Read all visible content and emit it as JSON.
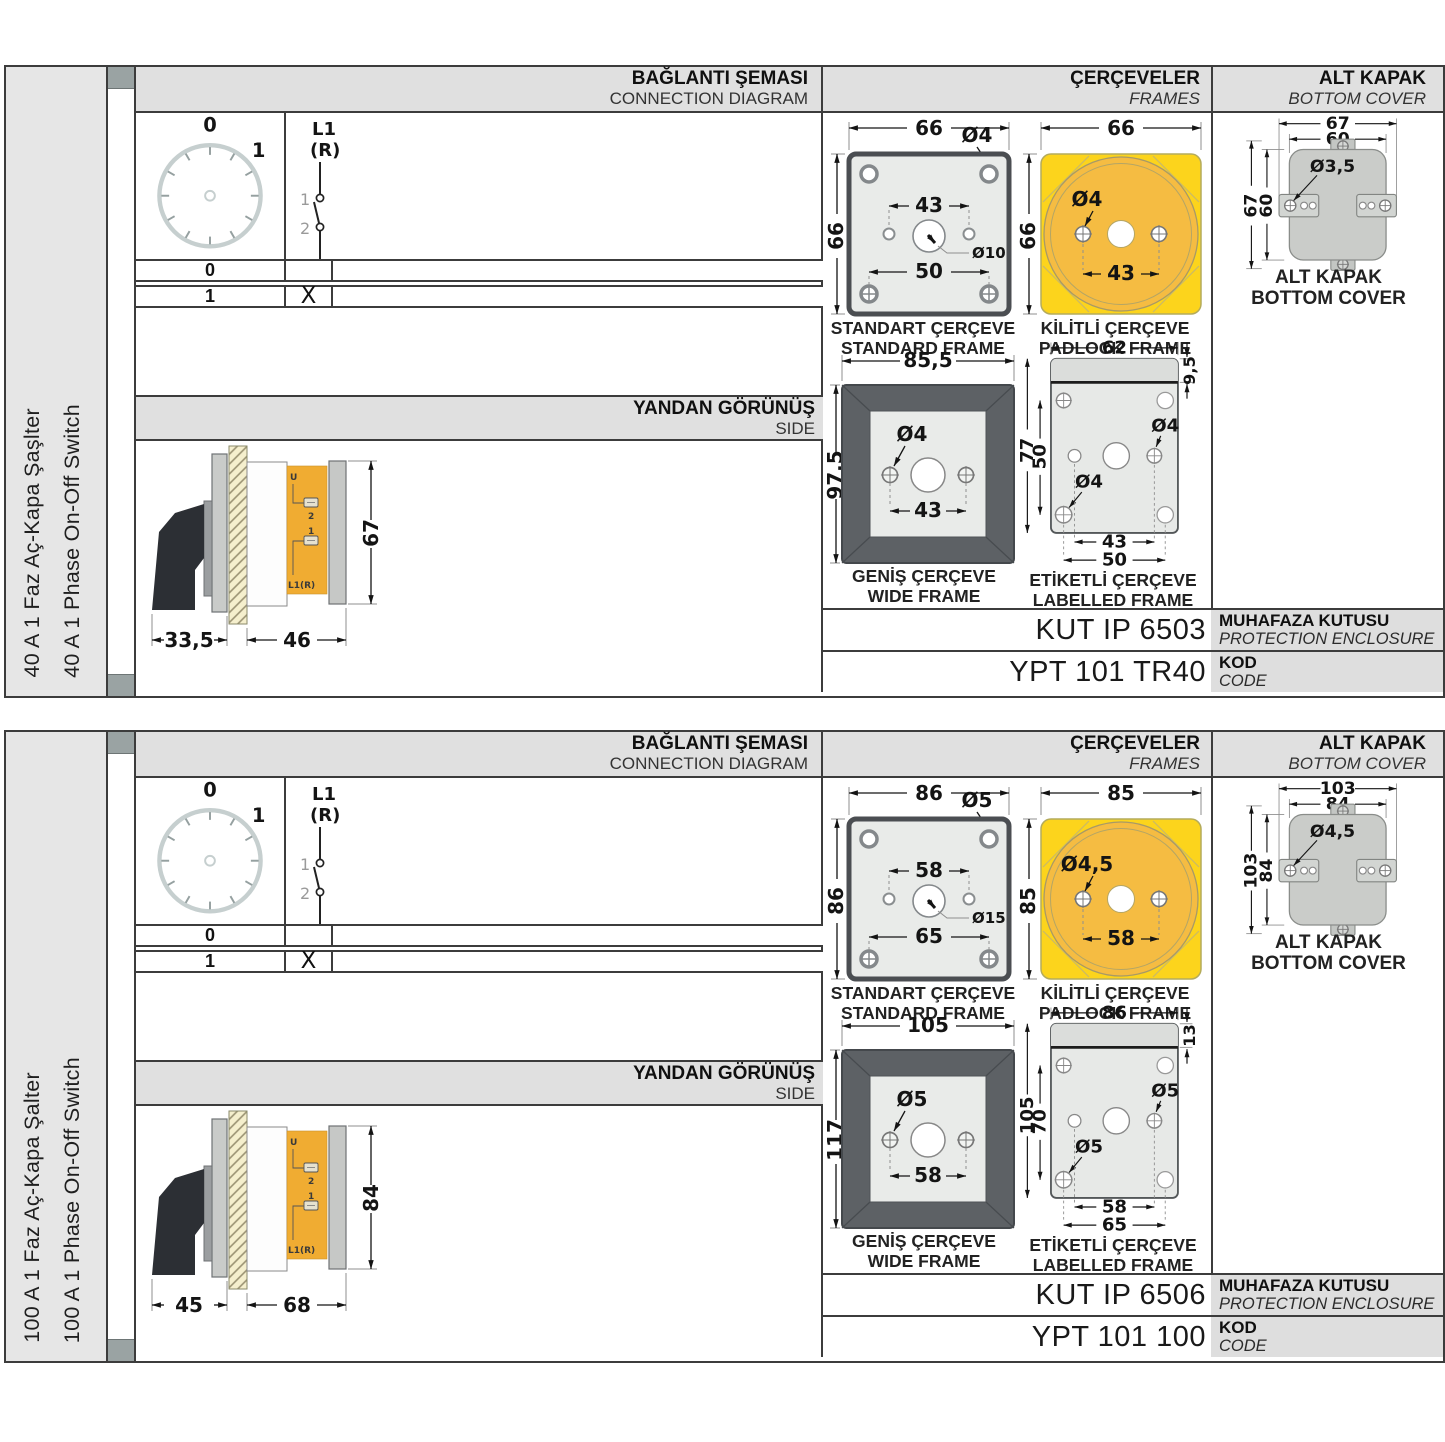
{
  "colors": {
    "padlock_yellow": "#fcd41c",
    "padlock_circle": "#f5bc42",
    "label_orange": "#f0ac32",
    "handle_dark": "#2c2f34",
    "header_gray": "#e0e0e0"
  },
  "panels": [
    {
      "product_tr": "40 A 1 Faz Aç-Kapa Şaşlter",
      "product_en": "40 A 1 Phase On-Off Switch",
      "headers": {
        "diagram_tr": "BAĞLANTI ŞEMASI",
        "diagram_en": "CONNECTION DIAGRAM",
        "frames_tr": "ÇERÇEVELER",
        "frames_en": "FRAMES",
        "cover_tr": "ALT KAPAK",
        "cover_en": "BOTTOM COVER"
      },
      "diagram": {
        "pos0": "0",
        "pos1": "1",
        "t_top1": "L1",
        "t_top2": "(R)",
        "c1": "1",
        "c2": "2",
        "t_bot": "U",
        "rows": [
          {
            "pos": "0",
            "state": ""
          },
          {
            "pos": "1",
            "state": "X"
          }
        ]
      },
      "side_view": {
        "title_tr": "YANDAN GÖRÜNÜŞ",
        "title_en": "SIDE",
        "dim_a": "33,5",
        "dim_b": "46",
        "dim_h": "67",
        "lbl_u": "U",
        "lbl_1": "1",
        "lbl_2": "2",
        "lbl_l1r": "L1(R)"
      },
      "frames": {
        "standard": {
          "cap_tr": "STANDART ÇERÇEVE",
          "cap_en": "STANDARD FRAME",
          "w": "66",
          "h": "66",
          "hole": "Ø4",
          "pitch": "43",
          "center_hole": "Ø10",
          "pitch_outer": "50"
        },
        "padlock": {
          "cap_tr": "KİLİTLİ ÇERÇEVE",
          "cap_en": "PADLOCK FRAME",
          "w": "66",
          "h": "66",
          "hole": "Ø4",
          "pitch": "43"
        },
        "wide": {
          "cap_tr": "GENİŞ ÇERÇEVE",
          "cap_en": "WIDE FRAME",
          "w": "85,5",
          "h": "97,5",
          "hole": "Ø4",
          "pitch": "43"
        },
        "labelled": {
          "cap_tr": "ETİKETLİ ÇERÇEVE",
          "cap_en": "LABELLED FRAME",
          "w": "62",
          "strip_h": "9,5",
          "h": "77",
          "inner_h": "50",
          "hole1": "Ø4",
          "hole2": "Ø4",
          "pitch": "43",
          "pitch_outer": "50"
        }
      },
      "cover": {
        "cap_tr": "ALT KAPAK",
        "cap_en": "BOTTOM COVER",
        "w1": "67",
        "w2": "60",
        "hole": "Ø3,5",
        "h1": "67",
        "h2": "60"
      },
      "enclosure": {
        "value": "KUT IP 6503",
        "label_tr": "MUHAFAZA KUTUSU",
        "label_en": "PROTECTION ENCLOSURE"
      },
      "code": {
        "value": "YPT 101 TR40",
        "label_tr": "KOD",
        "label_en": "CODE"
      }
    },
    {
      "product_tr": "100 A 1 Faz Aç-Kapa Şalter",
      "product_en": "100 A 1 Phase On-Off Switch",
      "headers": {
        "diagram_tr": "BAĞLANTI ŞEMASI",
        "diagram_en": "CONNECTION DIAGRAM",
        "frames_tr": "ÇERÇEVELER",
        "frames_en": "FRAMES",
        "cover_tr": "ALT KAPAK",
        "cover_en": "BOTTOM COVER"
      },
      "diagram": {
        "pos0": "0",
        "pos1": "1",
        "t_top1": "L1",
        "t_top2": "(R)",
        "c1": "1",
        "c2": "2",
        "t_bot": "U",
        "rows": [
          {
            "pos": "0",
            "state": ""
          },
          {
            "pos": "1",
            "state": "X"
          }
        ]
      },
      "side_view": {
        "title_tr": "YANDAN GÖRÜNÜŞ",
        "title_en": "SIDE",
        "dim_a": "45",
        "dim_b": "68",
        "dim_h": "84",
        "lbl_u": "U",
        "lbl_1": "1",
        "lbl_2": "2",
        "lbl_l1r": "L1(R)"
      },
      "frames": {
        "standard": {
          "cap_tr": "STANDART ÇERÇEVE",
          "cap_en": "STANDARD FRAME",
          "w": "86",
          "h": "86",
          "hole": "Ø5",
          "pitch": "58",
          "center_hole": "Ø15",
          "pitch_outer": "65"
        },
        "padlock": {
          "cap_tr": "KİLİTLİ ÇERÇEVE",
          "cap_en": "PADLOCK FRAME",
          "w": "85",
          "h": "85",
          "hole": "Ø4,5",
          "pitch": "58"
        },
        "wide": {
          "cap_tr": "GENİŞ ÇERÇEVE",
          "cap_en": "WIDE FRAME",
          "w": "105",
          "h": "117",
          "hole": "Ø5",
          "pitch": "58"
        },
        "labelled": {
          "cap_tr": "ETİKETLİ ÇERÇEVE",
          "cap_en": "LABELLED FRAME",
          "w": "86",
          "strip_h": "13",
          "h": "105",
          "inner_h": "70",
          "hole1": "Ø5",
          "hole2": "Ø5",
          "pitch": "58",
          "pitch_outer": "65"
        }
      },
      "cover": {
        "cap_tr": "ALT KAPAK",
        "cap_en": "BOTTOM COVER",
        "w1": "103",
        "w2": "84",
        "hole": "Ø4,5",
        "h1": "103",
        "h2": "84"
      },
      "enclosure": {
        "value": "KUT IP 6506",
        "label_tr": "MUHAFAZA KUTUSU",
        "label_en": "PROTECTION ENCLOSURE"
      },
      "code": {
        "value": "YPT 101 100",
        "label_tr": "KOD",
        "label_en": "CODE"
      }
    }
  ]
}
